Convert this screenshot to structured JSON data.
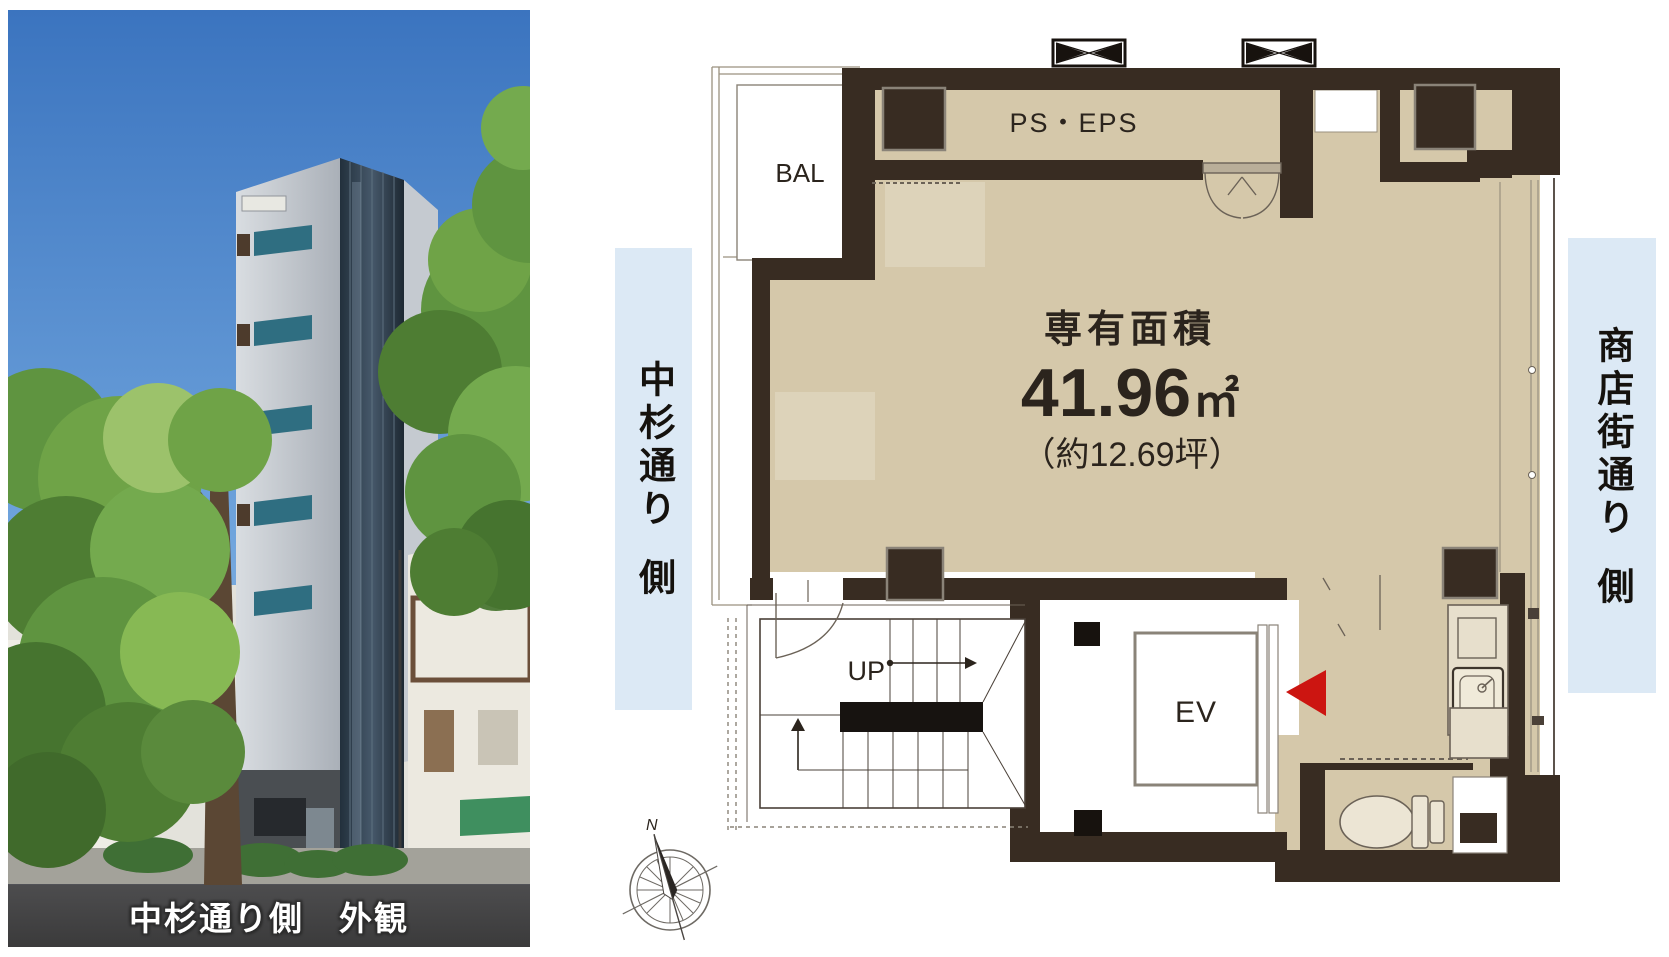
{
  "photo": {
    "caption": "中杉通り側　外観"
  },
  "floor_plan": {
    "balcony_label": "BAL",
    "ps_eps_label": "PS・EPS",
    "stairs_up_label": "UP",
    "elevator_label": "EV",
    "area_title": "専有面積",
    "area_value": "41.96",
    "area_unit": "㎡",
    "area_tsubo": "（約12.69坪）",
    "colors": {
      "floor": "#d5c8aa",
      "floor_light": "#ddd3ba",
      "wall": "#382c22",
      "entrance_marker": "#cc1511",
      "street_band": "#dce9f5"
    }
  },
  "street_labels": {
    "left": {
      "street": "中杉通り",
      "side": "側"
    },
    "right": {
      "street": "商店街通り",
      "side": "側"
    }
  },
  "compass": {
    "north_label": "N"
  }
}
